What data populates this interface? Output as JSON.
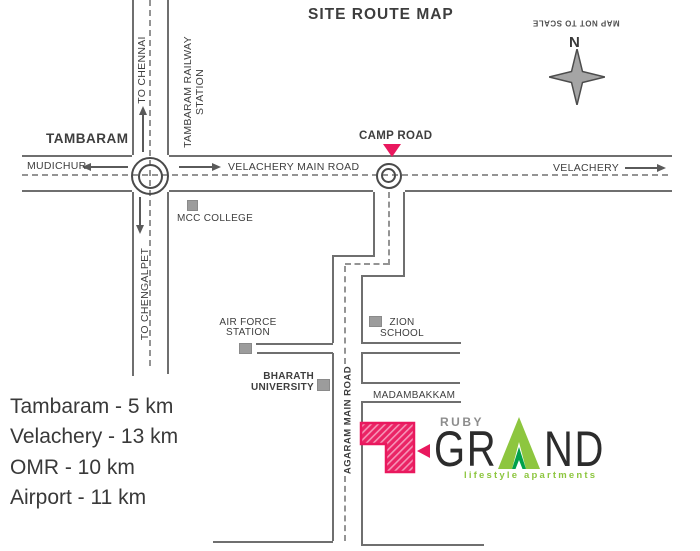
{
  "title": "SITE ROUTE MAP",
  "compass": {
    "north": "N",
    "note": "MAP NOT TO SCALE"
  },
  "roads": {
    "velachery_main_road": "VELACHERY MAIN ROAD",
    "camp_road": "CAMP ROAD",
    "agaram_main_road": "AGARAM MAIN ROAD",
    "madambakkam": "MADAMBAKKAM"
  },
  "directions": {
    "tambaram": "TAMBARAM",
    "mudichur": "MUDICHUR",
    "velachery": "VELACHERY",
    "to_chennai": "TO CHENNAI",
    "to_chengalpet": "TO CHENGALPET"
  },
  "landmarks": {
    "tambaram_railway_line1": "TAMBARAM RAILWAY",
    "tambaram_railway_line2": "STATION",
    "mcc_college": "MCC COLLEGE",
    "air_force_line1": "AIR FORCE",
    "air_force_line2": "STATION",
    "zion_line1": "ZION",
    "zion_line2": "SCHOOL",
    "bharath_line1": "BHARATH",
    "bharath_line2": "UNIVERSITY"
  },
  "distances": [
    "Tambaram - 5 km",
    "Velachery - 13 km",
    "OMR - 10 km",
    "Airport - 11 km"
  ],
  "logo": {
    "name_top": "RUBY",
    "name_left": "GR",
    "name_right": "ND",
    "tagline": "lifestyle apartments"
  },
  "colors": {
    "accent_pink": "#e9185e",
    "logo_green": "#8dc63f",
    "logo_dark_green": "#00a14b",
    "road_gray": "#6f6f6f",
    "text_gray": "#3e3e3e"
  }
}
